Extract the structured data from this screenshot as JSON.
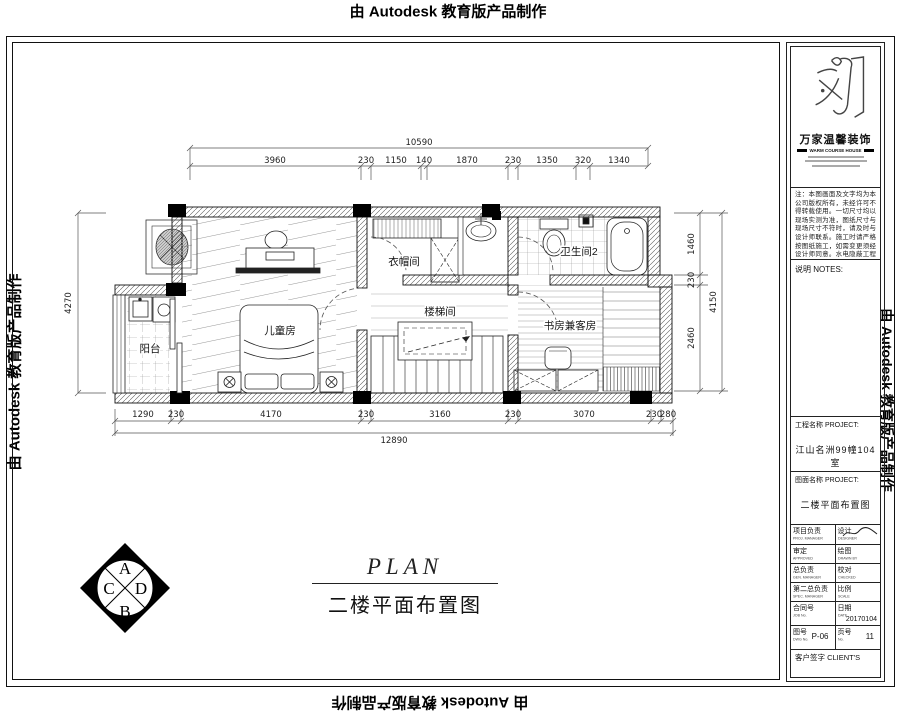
{
  "watermark": "由 Autodesk 教育版产品制作",
  "plan": {
    "rooms": {
      "balcony": "阳台",
      "kids": "儿童房",
      "cloak": "衣帽间",
      "stair": "楼梯间",
      "bath": "卫生间2",
      "study": "书房兼客房"
    },
    "dims": {
      "top_total": "10590",
      "top": [
        "3960",
        "230",
        "1150",
        "140",
        "1870",
        "230",
        "1350",
        "320",
        "1340"
      ],
      "bottom": [
        "1290",
        "230",
        "4170",
        "230",
        "3160",
        "230",
        "3070",
        "230",
        "280"
      ],
      "bottom_total": "12890",
      "left": "4270",
      "right": [
        "1460",
        "230",
        "2460"
      ],
      "right_total": "4150"
    },
    "caption_en": "PLAN",
    "caption_zh": "二楼平面布置图",
    "compass": {
      "top": "A",
      "right": "D",
      "bottom": "B",
      "left": "C"
    }
  },
  "titleblock": {
    "company_zh": "万家温馨装饰",
    "company_en": "WARM COURSE HOUSE",
    "notes_body": "注：本图画面及文字均为本公司版权所有，未经许可不得转载使用。一切尺寸均以现场实测为准，图纸尺寸与现场尺寸不符时，请及时与设计师联系。施工时请严格按图纸施工，如需变更须经设计师同意。水电隐蔽工程完工后须经验收合格方可封闭。本图仅供本工程使用。",
    "notes_label": "说明  NOTES:",
    "project_label": "工程名称 PROJECT:",
    "project_value": "江山名洲99幢104室",
    "drawing_label": "图面名称 PROJECT:",
    "drawing_value": "二楼平面布置图",
    "table": {
      "r1l": "项目负责",
      "r1l_en": "PROJ. MANAGER",
      "r1r": "设计",
      "r1r_en": "DESIGNER",
      "r2l": "审定",
      "r2l_en": "APPROVED",
      "r2r": "绘图",
      "r2r_en": "DRAWN BY",
      "r3l": "总负责",
      "r3l_en": "GEN. MANAGER",
      "r3r": "校对",
      "r3r_en": "CHECKED",
      "r4l": "第二总负责",
      "r4l_en": "SPEC. MANAGER",
      "r4r": "比例",
      "r4r_en": "SCALE",
      "r5l": "合同号",
      "r5l_en": "JOB No.",
      "r5r": "日期",
      "r5r_en": "DATE",
      "date": "20170104",
      "r6l": "图号",
      "r6l_en": "DWG No.",
      "dwg": "P-06",
      "r6r": "页号",
      "r6r_en": "No.",
      "page": "11",
      "r7": "客户签字 CLIENT'S"
    }
  }
}
